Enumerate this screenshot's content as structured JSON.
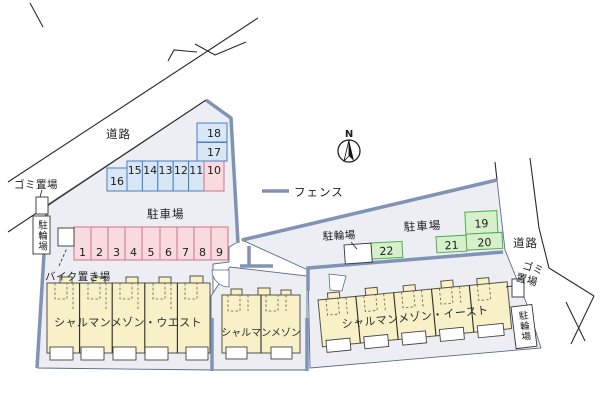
{
  "legend": {
    "fence_label": "フェンス"
  },
  "compass": {
    "north_label": "N"
  },
  "roads": {
    "left_label": "道路",
    "right_label": "道路"
  },
  "areas": {
    "parking_west_label": "駐車場",
    "parking_east_label": "駐車場",
    "garbage_left_label": "ゴミ置場",
    "garbage_right_line1": "ゴミ",
    "garbage_right_line2": "置場",
    "bicycle_left_label": "駐輪場",
    "bicycle_center_label": "駐輪場",
    "bicycle_right_label": "駐輪場",
    "bike_storage_label": "バイク置き場"
  },
  "buildings": {
    "west": "シャルマンメゾン・ウエスト",
    "center": "シャルマンメゾン",
    "east": "シャルマンメゾン・イースト"
  },
  "spaces": {
    "front_row": [
      "1",
      "2",
      "3",
      "4",
      "5",
      "6",
      "7",
      "8",
      "9"
    ],
    "back_row": [
      "16",
      "15",
      "14",
      "13",
      "12",
      "11",
      "10"
    ],
    "side_column": [
      "18",
      "17"
    ],
    "east_lot": [
      "19",
      "20",
      "21",
      "22"
    ]
  },
  "colors": {
    "fence": "#8093b6",
    "space_blue_fill": "#d8e7f6",
    "space_blue_border": "#4d7ec0",
    "space_pink_fill": "#f9dade",
    "space_pink_border": "#cf7287",
    "space_green_fill": "#d6f0cc",
    "space_green_border": "#54ad52",
    "building_fill": "#f8f1c8",
    "parcel_fill": "#eceef3"
  }
}
